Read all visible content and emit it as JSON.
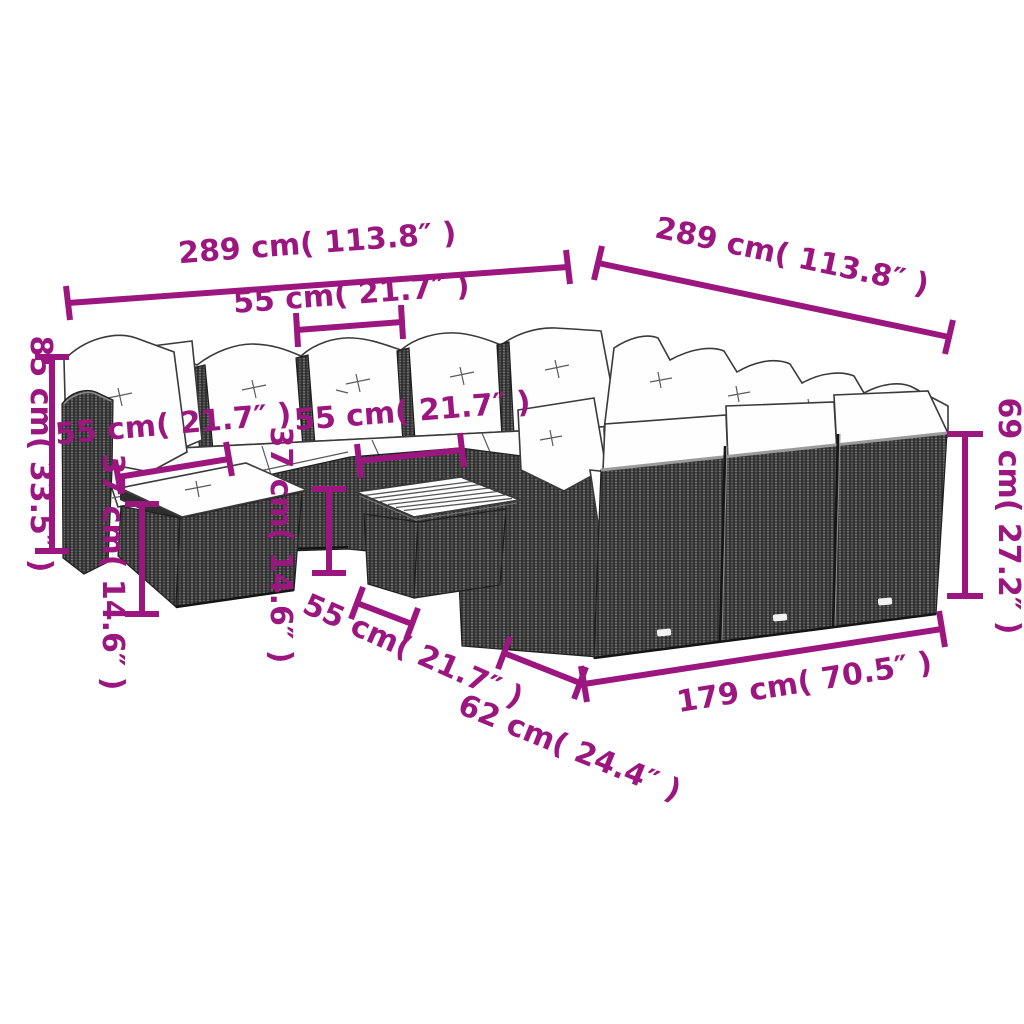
{
  "diagram": {
    "background_color": "#FFFFFF",
    "accent_color": "#9C1680",
    "illustration": "outdoor-rattan-sectional-lounge-set-with-ottoman-and-coffee-table",
    "dimensions": {
      "left_total_length": {
        "label": "289 cm( 113.8″ )",
        "meaning": "total length of left section"
      },
      "right_total_length": {
        "label": "289 cm( 113.8″ )",
        "meaning": "total length of right section"
      },
      "seat_width_top": {
        "label": "55 cm( 21.7″ )",
        "meaning": "single seat width (back row)"
      },
      "seat_width_left": {
        "label": "55 cm( 21.7″ )",
        "meaning": "single seat width (left)"
      },
      "seat_width_middle": {
        "label": "55 cm( 21.7″ )",
        "meaning": "single seat width (middle)"
      },
      "back_height_left": {
        "label": "85 cm( 33.5″ )",
        "meaning": "total height with back cushion"
      },
      "seat_height": {
        "label": "37 cm( 14.6″ )",
        "meaning": "ottoman / seat height"
      },
      "table_height": {
        "label": "37 cm( 14.6″ )",
        "meaning": "coffee table height"
      },
      "back_height_right": {
        "label": "69 cm( 27.2″ )",
        "meaning": "backrest frame height"
      },
      "ottoman_depth": {
        "label": "55 cm( 21.7″ )",
        "meaning": "ottoman depth"
      },
      "table_depth": {
        "label": "62 cm( 24.4″ )",
        "meaning": "table depth"
      },
      "front_length": {
        "label": "179 cm( 70.5″ )",
        "meaning": "front section length"
      }
    }
  }
}
